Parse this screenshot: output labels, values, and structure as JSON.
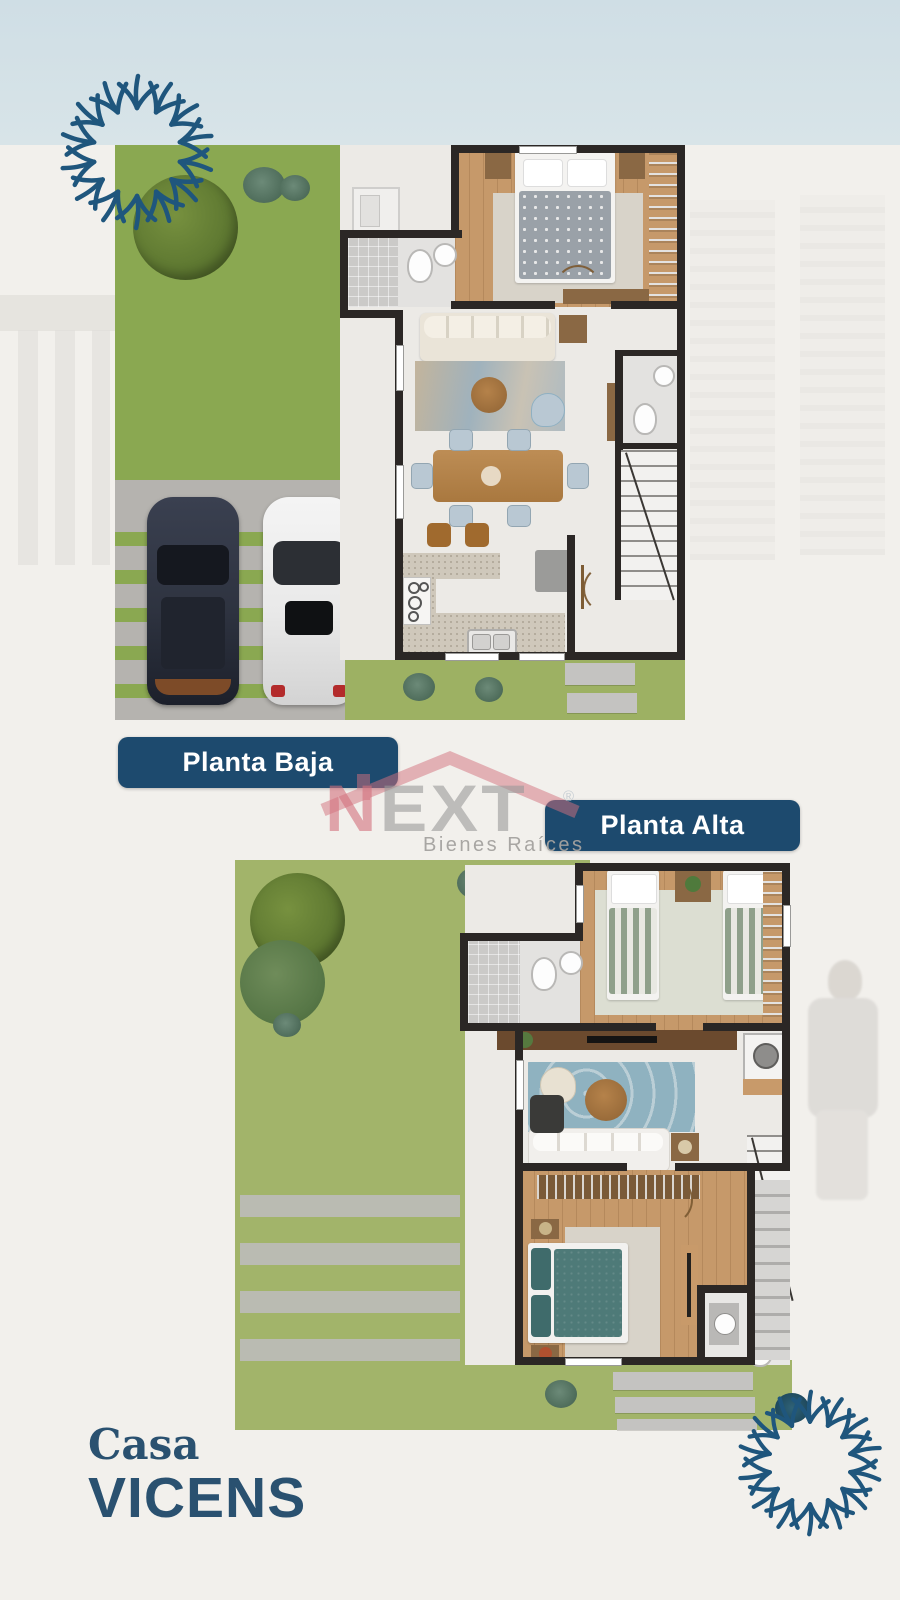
{
  "floor_labels": {
    "planta_baja": "Planta Baja",
    "planta_alta": "Planta Alta"
  },
  "logo": {
    "n": "N",
    "ext": "EXT",
    "registered": "®",
    "subtitle": "Bienes Raíces"
  },
  "title_block": {
    "line1": "Casa",
    "line2": "VICENS"
  },
  "colors": {
    "background": "#f2f0ec",
    "sky": "#cfdee5",
    "badge_bg": "#1d4a6e",
    "badge_text": "#ffffff",
    "title_text": "#2a5170",
    "ornament": "#1f567d",
    "logo_pink": "#d4717e",
    "logo_gray": "#9a9a9a",
    "lawn_front": "#8aa851",
    "lawn_back": "#a2b46a",
    "concrete": "#b5b3af",
    "wall": "#2b2725",
    "wood_floor": "#c6996a",
    "wood_dark": "#8a6844",
    "tile_floor": "#eceae6",
    "accent_blue": "#b9c8d3",
    "rug_blue": "#8fb2c0",
    "rug_light": "#d8d3c9",
    "sofa_beige": "#eae4d8",
    "sofa_white": "#f1efec",
    "duvet_gray": "#9aa1a8",
    "duvet_teal": "#4e7a78",
    "stripe_green": "#8fa08b",
    "car_dark": "#2e3340",
    "car_white": "#e9e9e9"
  }
}
